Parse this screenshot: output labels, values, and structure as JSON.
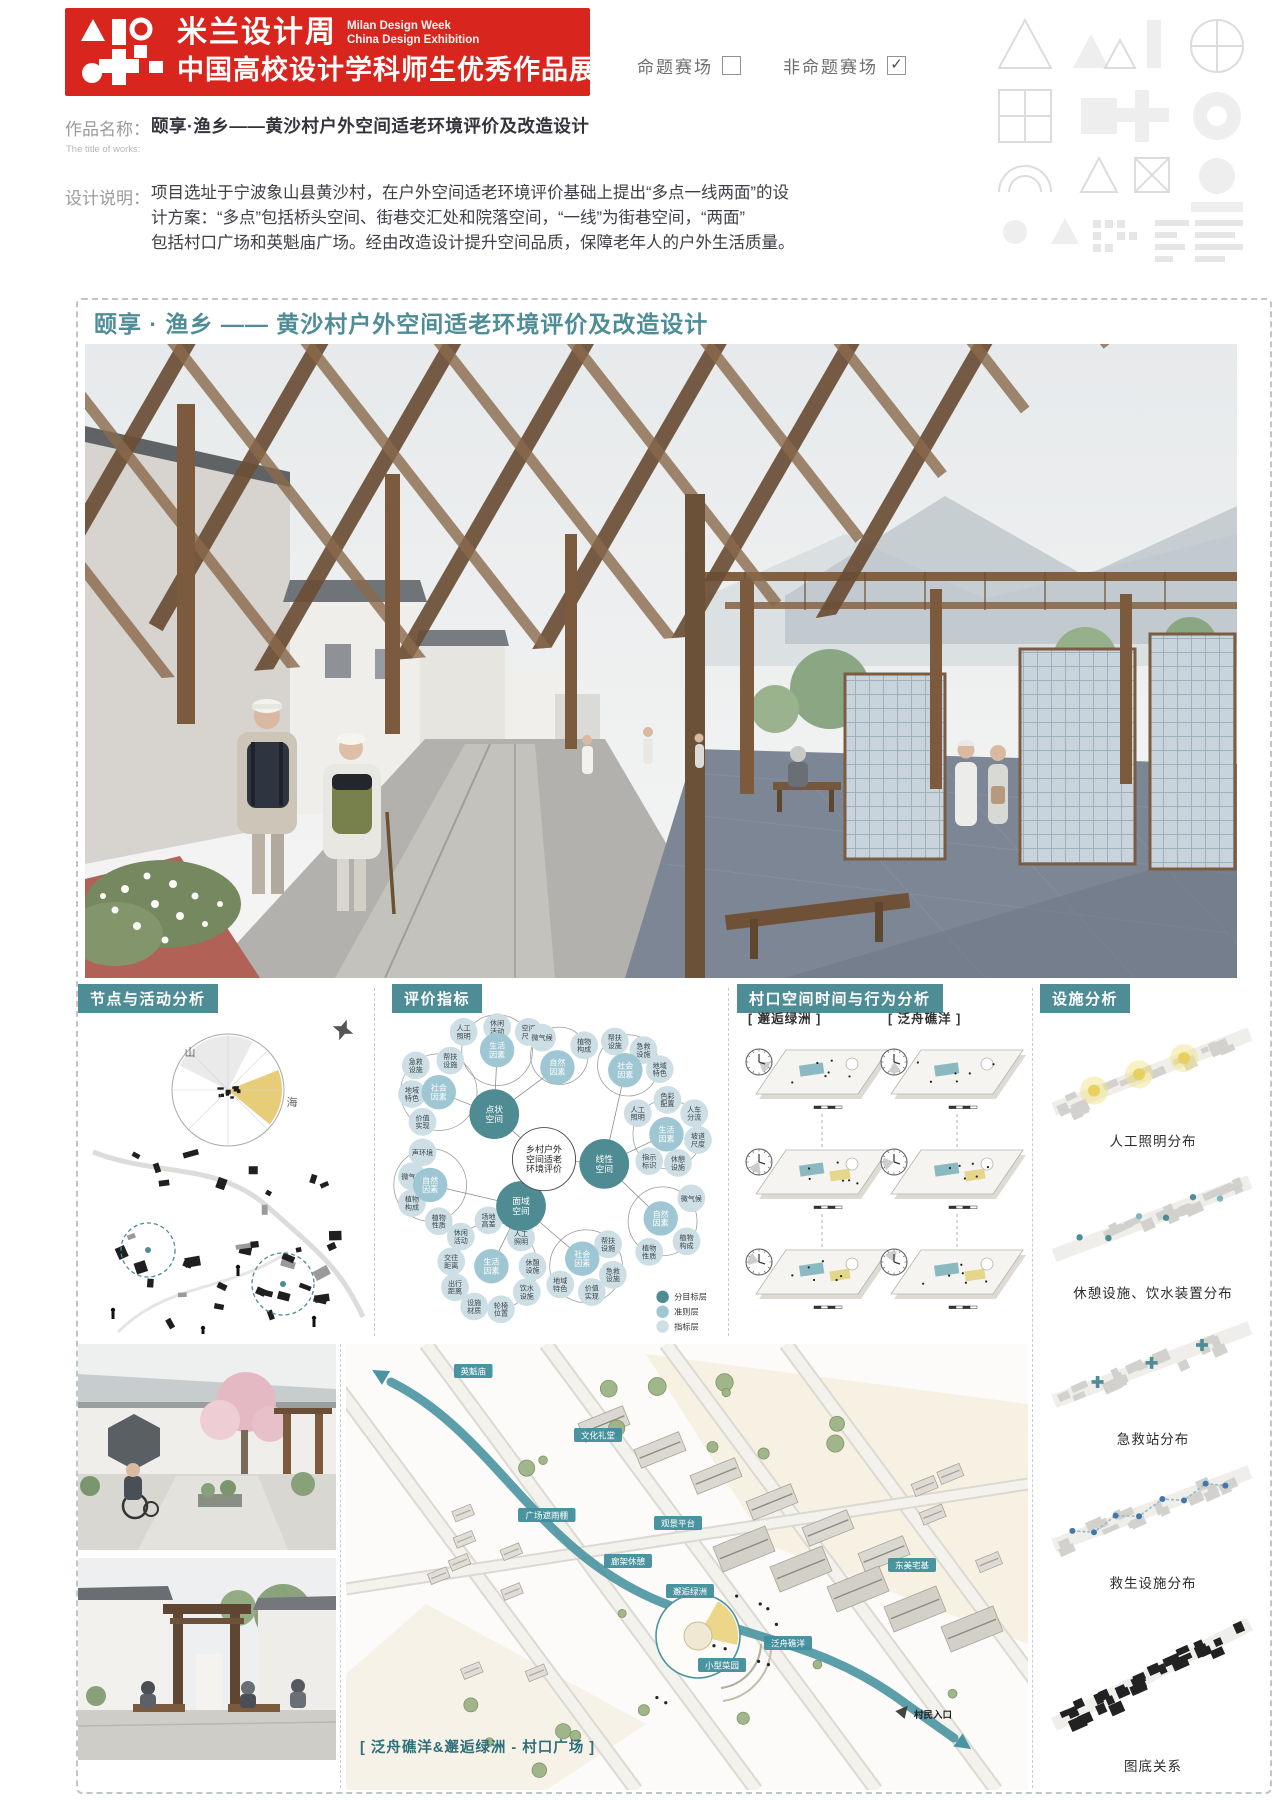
{
  "banner": {
    "logo_title": "米兰设计周",
    "logo_sub1": "Milan Design Week",
    "logo_sub2": "China Design Exhibition",
    "logo_main": "中国高校设计学科师生优秀作品展"
  },
  "checkboxes": {
    "items": [
      {
        "label": "命题赛场",
        "checked": false
      },
      {
        "label": "非命题赛场",
        "checked": true
      }
    ],
    "check_glyph": "✓"
  },
  "work": {
    "name_label": "作品名称：",
    "name_value": "颐享·渔乡——黄沙村户外空间适老环境评价及改造设计",
    "name_sub": "The title of works:",
    "desc_label": "设计说明：",
    "description_lines": [
      "项目选址于宁波象山县黄沙村，在户外空间适老环境评价基础上提出“多点一线两面”的设",
      "计方案：“多点”包括桥头空间、街巷交汇处和院落空间，“一线”为街巷空间，“两面”",
      "包括村口广场和英魁庙广场。经由改造设计提升空间品质，保障老年人的户外生活质量。"
    ]
  },
  "board": {
    "title": "颐享 · 渔乡 —— 黄沙村户外空间适老环境评价及改造设计"
  },
  "panels": {
    "nodes": {
      "header": "节点与活动分析",
      "mountain": "山",
      "sea": "海"
    },
    "evaluation": {
      "header": "评价指标",
      "legend": [
        {
          "label": "分目标层",
          "type": "g"
        },
        {
          "label": "准则层",
          "type": "c"
        },
        {
          "label": "指标层",
          "type": "i"
        }
      ],
      "nodes": [
        [
          "ctr",
          152,
          150,
          "乡村户外|空间适老|环境评价"
        ],
        [
          "g",
          100,
          103,
          "点状空间"
        ],
        [
          "g",
          215,
          155,
          "线性空间"
        ],
        [
          "g",
          128,
          199,
          "面域空间"
        ],
        [
          "c",
          103,
          36,
          "生活因素"
        ],
        [
          "c",
          166,
          54,
          "自然因素"
        ],
        [
          "c",
          42,
          80,
          "社会因素"
        ],
        [
          "c",
          237,
          57,
          "社会因素"
        ],
        [
          "c",
          280,
          124,
          "生活因素"
        ],
        [
          "c",
          274,
          212,
          "自然因素"
        ],
        [
          "c",
          33,
          177,
          "自然因素"
        ],
        [
          "c",
          97,
          262,
          "生活因素"
        ],
        [
          "c",
          192,
          254,
          "社会因素"
        ],
        [
          "i",
          68,
          17,
          "人工照明"
        ],
        [
          "i",
          103,
          12,
          "休闲活动"
        ],
        [
          "i",
          136,
          17,
          "空间尺度"
        ],
        [
          "i",
          150,
          23,
          "微气候"
        ],
        [
          "i",
          194,
          31,
          "植物构成"
        ],
        [
          "i",
          18,
          52,
          "急救设施"
        ],
        [
          "i",
          54,
          47,
          "帮扶设施"
        ],
        [
          "i",
          14,
          82,
          "地域特色"
        ],
        [
          "i",
          25,
          111,
          "价值实现"
        ],
        [
          "i",
          226,
          27,
          "帮扶设施"
        ],
        [
          "i",
          256,
          36,
          "急救设施"
        ],
        [
          "i",
          273,
          56,
          "地域特色"
        ],
        [
          "i",
          250,
          102,
          "人工照明"
        ],
        [
          "i",
          281,
          88,
          "色彩配置"
        ],
        [
          "i",
          309,
          102,
          "人车分流"
        ],
        [
          "i",
          313,
          130,
          "坡道尺度"
        ],
        [
          "i",
          292,
          154,
          "休憩设施"
        ],
        [
          "i",
          262,
          152,
          "指示标识"
        ],
        [
          "i",
          306,
          191,
          "微气候"
        ],
        [
          "i",
          301,
          236,
          "植物构成"
        ],
        [
          "i",
          262,
          247,
          "植物性质"
        ],
        [
          "i",
          25,
          143,
          "声环境"
        ],
        [
          "i",
          14,
          168,
          "微气候"
        ],
        [
          "i",
          14,
          196,
          "植物构成"
        ],
        [
          "i",
          42,
          215,
          "植物性质"
        ],
        [
          "i",
          94,
          214,
          "场地高差"
        ],
        [
          "i",
          65,
          231,
          "休闲活动"
        ],
        [
          "i",
          55,
          257,
          "交往距离"
        ],
        [
          "i",
          59,
          284,
          "出行距离"
        ],
        [
          "i",
          79,
          304,
          "设施材质"
        ],
        [
          "i",
          107,
          307,
          "轮椅位置"
        ],
        [
          "i",
          134,
          289,
          "饮水设施"
        ],
        [
          "i",
          140,
          262,
          "休憩设施"
        ],
        [
          "i",
          128,
          232,
          "人工照明"
        ],
        [
          "i",
          219,
          239,
          "帮扶设施"
        ],
        [
          "i",
          224,
          271,
          "急救设施"
        ],
        [
          "i",
          202,
          289,
          "价值实现"
        ],
        [
          "i",
          169,
          281,
          "地域特色"
        ]
      ],
      "links": [
        [
          0,
          1
        ],
        [
          0,
          2
        ],
        [
          0,
          3
        ],
        [
          1,
          4
        ],
        [
          1,
          5
        ],
        [
          1,
          6
        ],
        [
          2,
          7
        ],
        [
          2,
          8
        ],
        [
          2,
          9
        ],
        [
          3,
          10
        ],
        [
          3,
          11
        ],
        [
          3,
          12
        ]
      ],
      "rings": [
        [
          103,
          36,
          37
        ],
        [
          168,
          42,
          30
        ],
        [
          42,
          80,
          40
        ],
        [
          240,
          52,
          32
        ],
        [
          281,
          124,
          36
        ],
        [
          276,
          215,
          36
        ],
        [
          33,
          177,
          38
        ],
        [
          99,
          262,
          46
        ],
        [
          196,
          262,
          38
        ]
      ]
    },
    "village": {
      "header": "村口空间时间与行为分析",
      "cols": [
        "[ 邂逅绿洲 ]",
        "[ 泛舟礁洋 ]"
      ]
    },
    "facility": {
      "header": "设施分析",
      "items": [
        {
          "caption": "人工照明分布",
          "type": "light"
        },
        {
          "caption": "休憩设施、饮水装置分布",
          "type": "rest"
        },
        {
          "caption": "急救站分布",
          "type": "aid"
        },
        {
          "caption": "救生设施分布",
          "type": "life"
        },
        {
          "caption": "图底关系",
          "type": "figure"
        }
      ]
    },
    "map": {
      "caption": "[ 泛舟礁洋&邂逅绿洲 - 村口广场 ]",
      "chips": [
        {
          "label": "英魁庙",
          "x": 108,
          "y": 20
        },
        {
          "label": "文化礼堂",
          "x": 228,
          "y": 84
        },
        {
          "label": "广场遮雨棚",
          "x": 172,
          "y": 164
        },
        {
          "label": "观景平台",
          "x": 308,
          "y": 172
        },
        {
          "label": "廊架休憩",
          "x": 258,
          "y": 210
        },
        {
          "label": "邂逅绿洲",
          "x": 320,
          "y": 240
        },
        {
          "label": "小型菜园",
          "x": 352,
          "y": 314
        },
        {
          "label": "泛舟礁洋",
          "x": 418,
          "y": 292
        },
        {
          "label": "东美宅基",
          "x": 542,
          "y": 214
        }
      ],
      "entry": {
        "label": "村民入口",
        "x": 568,
        "y": 374
      }
    }
  },
  "colors": {
    "red": "#d8251d",
    "teal": "#4e8c96",
    "goal": "#4f8b92",
    "criteria": "#9ec7d3",
    "indicator": "#cddee5",
    "yellow": "#e6c86a",
    "flow": "#4a93a0"
  }
}
